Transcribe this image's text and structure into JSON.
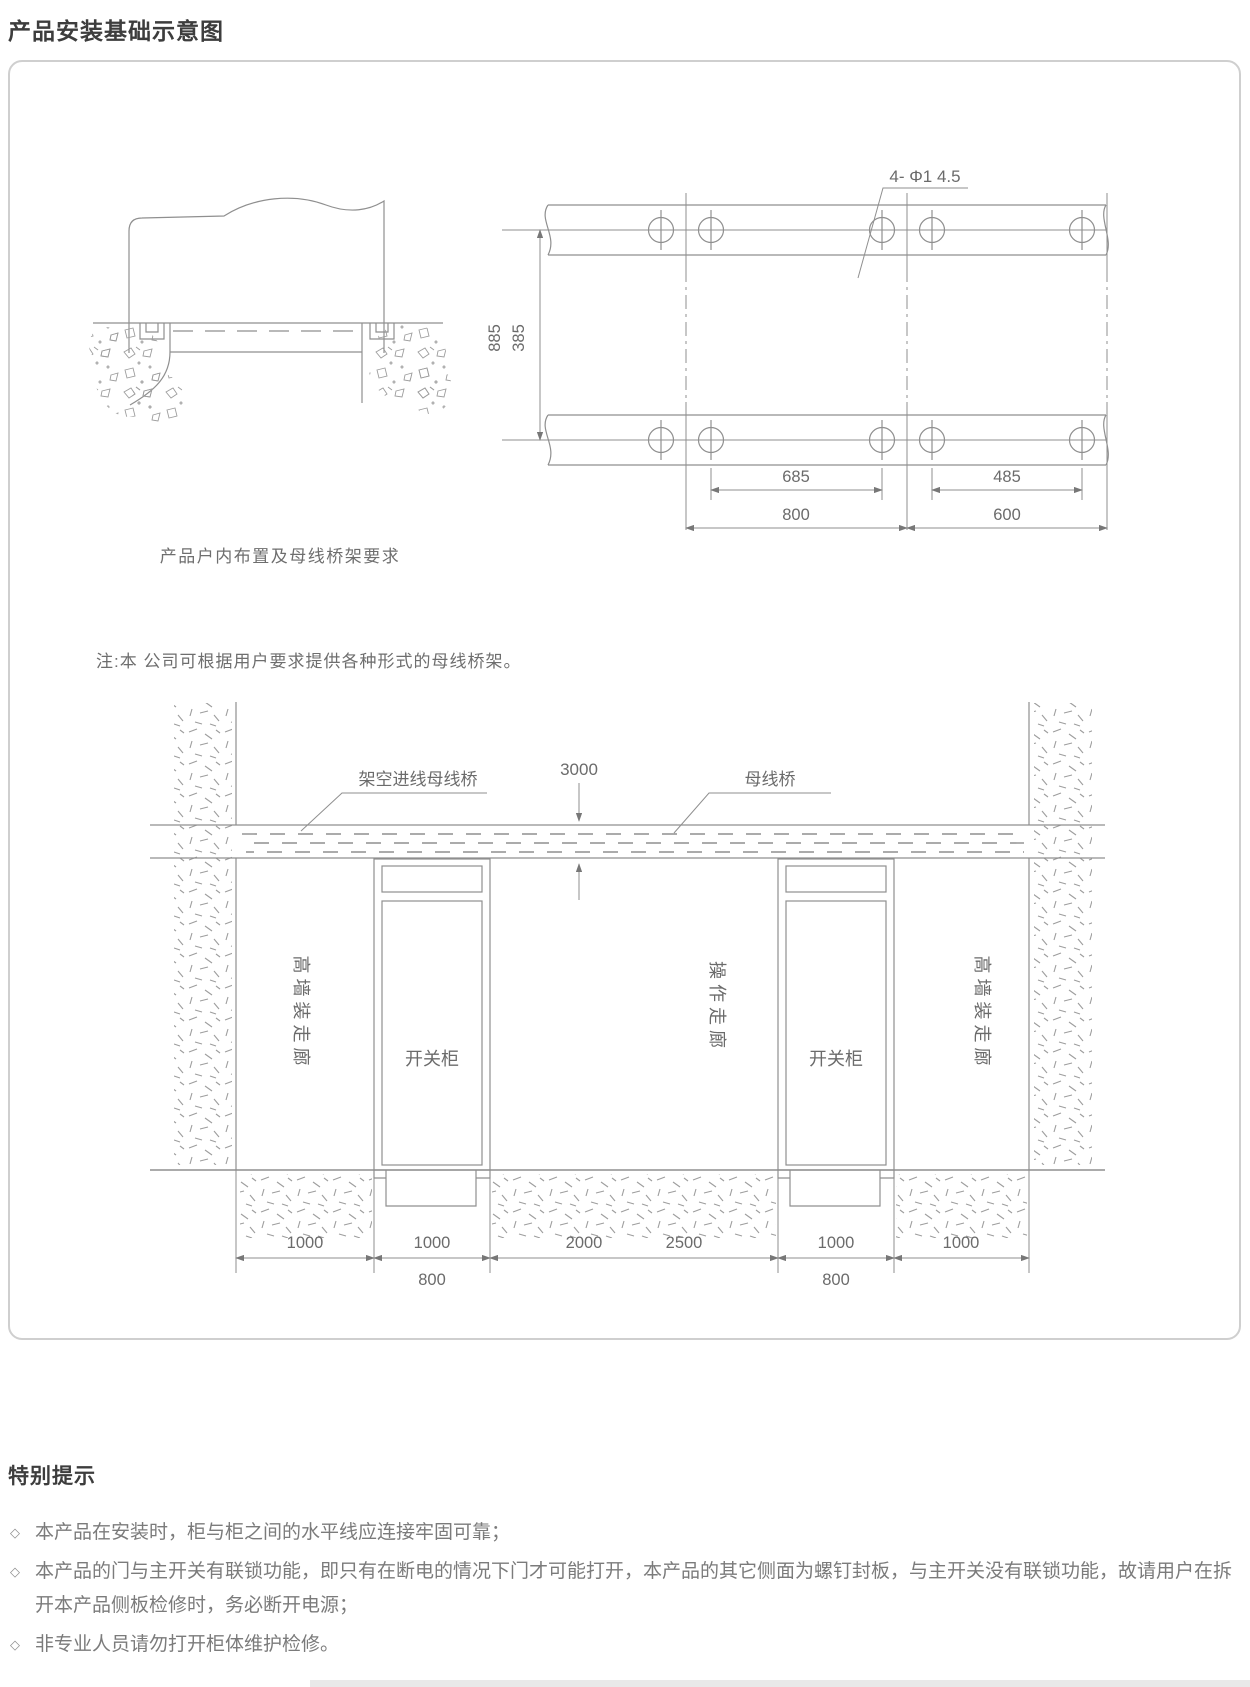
{
  "page": {
    "title": "产品安装基础示意图"
  },
  "foundation_section": {
    "indoor_layout": {
      "caption": "产品户内布置及母线桥架要求"
    },
    "note": "注:本 公司可根据用户要求提供各种形式的母线桥架。",
    "channel_drawing": {
      "hole_label": "4- Φ1 4.5",
      "dim_row_vertical": [
        "885",
        "385"
      ],
      "dim_hole_spacing_left": "685",
      "dim_hole_spacing_right": "485",
      "dim_width_left": "800",
      "dim_width_right": "600"
    },
    "room_section": {
      "label_overhead_busbar": "架空进线母线桥",
      "dim_clearance": "3000",
      "label_busbar": "母线桥",
      "label_left_corridor": "高墙装走廊",
      "label_cabinet_1": "开关柜",
      "label_center_corridor": "操作走廊",
      "label_cabinet_2": "开关柜",
      "label_right_corridor": "高墙装走廊",
      "dims": {
        "d1": "1000",
        "d2": "1000",
        "d3a": "2000",
        "d3b": "2500",
        "d4": "1000",
        "d5": "1000",
        "sub1": "800",
        "sub2": "800"
      }
    }
  },
  "special_notice": {
    "heading": "特别提示",
    "marker": "◇",
    "items": [
      "本产品在安装时，柜与柜之间的水平线应连接牢固可靠；",
      "本产品的门与主开关有联锁功能，即只有在断电的情况下门才可能打开，本产品的其它侧面为螺钉封板，与主开关没有联锁功能，故请用户在拆开本产品侧板检修时，务必断开电源；",
      "非专业人员请勿打开柜体维护检修。"
    ]
  }
}
